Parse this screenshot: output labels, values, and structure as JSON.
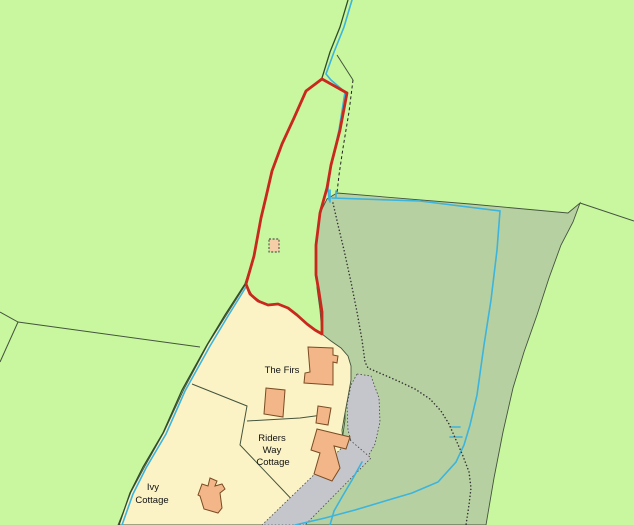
{
  "map": {
    "labels": {
      "the_firs": "The Firs",
      "riders_way_cottage": [
        "Riders",
        "Way",
        "Cottage"
      ],
      "ivy_cottage": [
        "Ivy",
        "Cottage"
      ]
    },
    "colors": {
      "field_light": "#c9f7a0",
      "field_dark": "#b7d0a2",
      "residential_area": "#fbf3c5",
      "building_fill": "#f2b688",
      "shed_fill": "#f5cda6",
      "building_outline": "#7a4b22",
      "site_boundary_red": "#c9281c",
      "water_blue": "#3cb4dc",
      "road_gray": "#c5c6cc",
      "field_line": "#44543c",
      "text": "#111111"
    }
  }
}
